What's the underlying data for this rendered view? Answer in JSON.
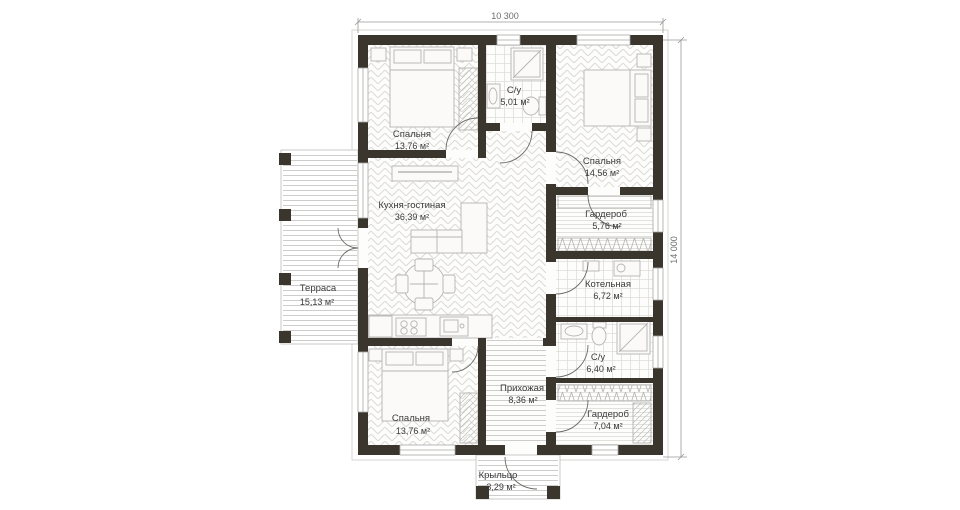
{
  "plan_title": "single-storey house floor plan",
  "dimensions": {
    "width_label": "10 300",
    "height_label": "14 000"
  },
  "rooms": {
    "bedroom_top_left": {
      "name": "Спальня",
      "area": "13,76 м²"
    },
    "bathroom_top": {
      "name": "С/у",
      "area": "5,01 м²"
    },
    "bedroom_top_right": {
      "name": "Спальня",
      "area": "14,56 м²"
    },
    "kitchen_living": {
      "name": "Кухня-гостиная",
      "area": "36,39 м²"
    },
    "wardrobe_top": {
      "name": "Гардероб",
      "area": "5,76 м²"
    },
    "terrace": {
      "name": "Терраса",
      "area": "15,13 м²"
    },
    "boiler": {
      "name": "Котельная",
      "area": "6,72 м²"
    },
    "bathroom_bottom": {
      "name": "С/у",
      "area": "6,40 м²"
    },
    "bedroom_bottom": {
      "name": "Спальня",
      "area": "13,76 м²"
    },
    "hallway": {
      "name": "Прихожая",
      "area": "8,36 м²"
    },
    "wardrobe_bottom": {
      "name": "Гардероб",
      "area": "7,04 м²"
    },
    "porch": {
      "name": "Крыльцо",
      "area": "3,29 м²"
    }
  },
  "colors": {
    "wall": "#3b362d",
    "floor_line": "#dcdad6",
    "furniture_line": "#b5b4b0",
    "dimension_line": "#8a8a88",
    "label_text": "#3b3b3b"
  }
}
